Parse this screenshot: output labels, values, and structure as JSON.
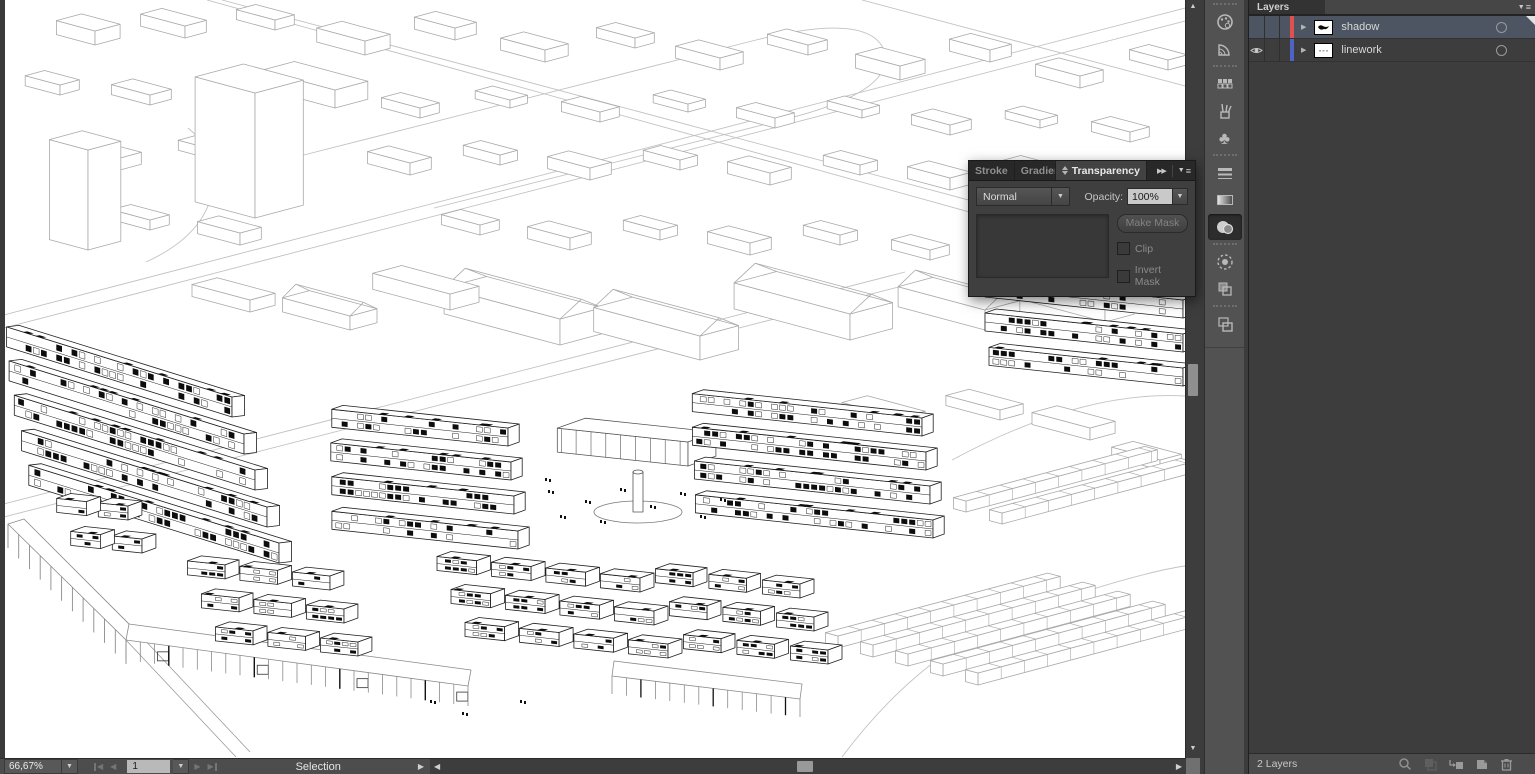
{
  "transparency_panel": {
    "tabs": [
      {
        "label": "Stroke",
        "active": false
      },
      {
        "label": "Gradient",
        "active": false
      },
      {
        "label": "Transparency",
        "active": true
      }
    ],
    "blend_mode_value": "Normal",
    "opacity_label": "Opacity:",
    "opacity_value": "100%",
    "make_mask_label": "Make Mask",
    "clip_label": "Clip",
    "invert_mask_label": "Invert Mask"
  },
  "layers_panel": {
    "title": "Layers",
    "rows": [
      {
        "name": "shadow",
        "visible": false,
        "selected": true,
        "color": "#e0514e"
      },
      {
        "name": "linework",
        "visible": true,
        "selected": false,
        "color": "#4f63c4"
      }
    ],
    "footer_count": "2 Layers"
  },
  "status_bar": {
    "zoom": "66,67%",
    "artboard": "1",
    "status": "Selection"
  },
  "dock": {
    "icons": [
      "color",
      "color-guide",
      "swatches",
      "brushes",
      "symbols",
      "stroke",
      "gradient",
      "transparency",
      "appearance",
      "graphic-styles",
      "artboards"
    ],
    "active_icon": "transparency"
  },
  "colors": {
    "selected_row": "#4d5562",
    "panel_bg": "#3f3f3f",
    "canvas_bg": "#ffffff"
  }
}
